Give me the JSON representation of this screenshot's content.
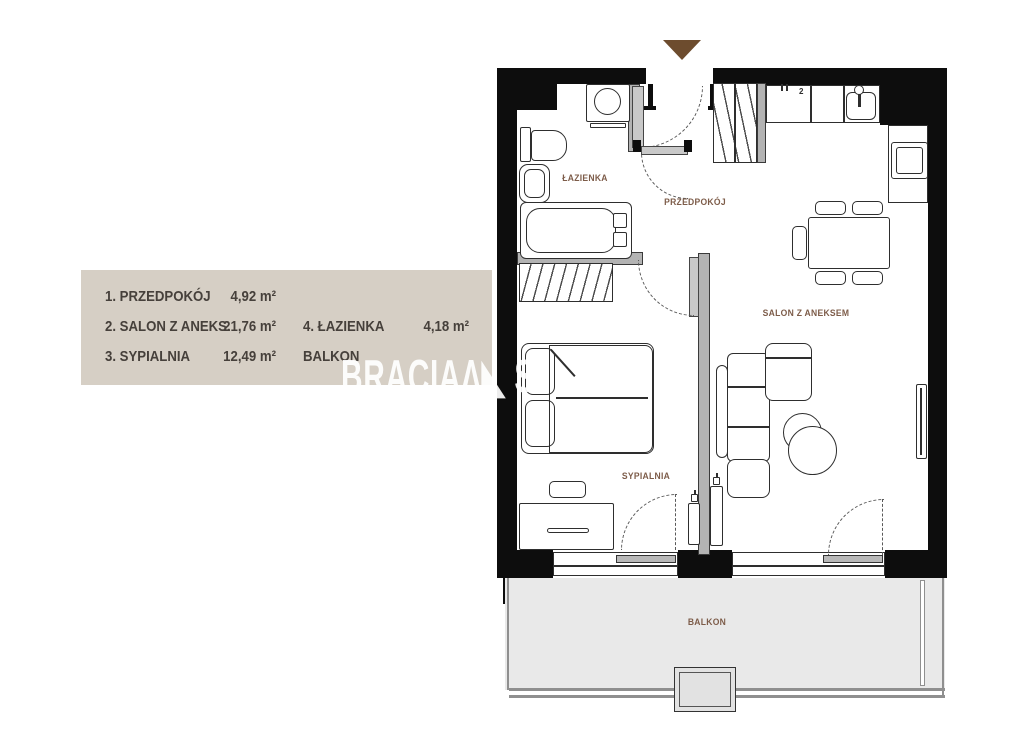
{
  "legend": {
    "rows": [
      {
        "left_label": "1. PRZEDPOKÓJ",
        "left_area": "4,92 m²",
        "right_label": "",
        "right_area": ""
      },
      {
        "left_label": "2. SALON Z ANEKS.",
        "left_area": "21,76 m²",
        "right_label": "4. ŁAZIENKA",
        "right_area": "4,18 m²"
      },
      {
        "left_label": "3. SYPIALNIA",
        "left_area": "12,49 m²",
        "right_label": "BALKON",
        "right_area": ""
      }
    ]
  },
  "rooms": {
    "bathroom": "ŁAZIENKA",
    "hallway": "PRZEDPOKÓJ",
    "living_room": "SALON Z ANEKSEM",
    "bedroom": "SYPIALNIA",
    "balcony": "BALKON"
  },
  "kitchen": {
    "hob_marker": "2"
  },
  "watermark": {
    "brand": "BRACIA",
    "logo_glyph": "Λ◣",
    "partial": "S"
  },
  "colors": {
    "wall": "#0d0d0d",
    "interior_wall": "#b3b3b3",
    "label": "#7d5c49",
    "legend_bg": "#d6cfc5",
    "legend_text": "#46403b",
    "arrow": "#6d4c2e",
    "balcony_fill": "#e9e9e9"
  }
}
